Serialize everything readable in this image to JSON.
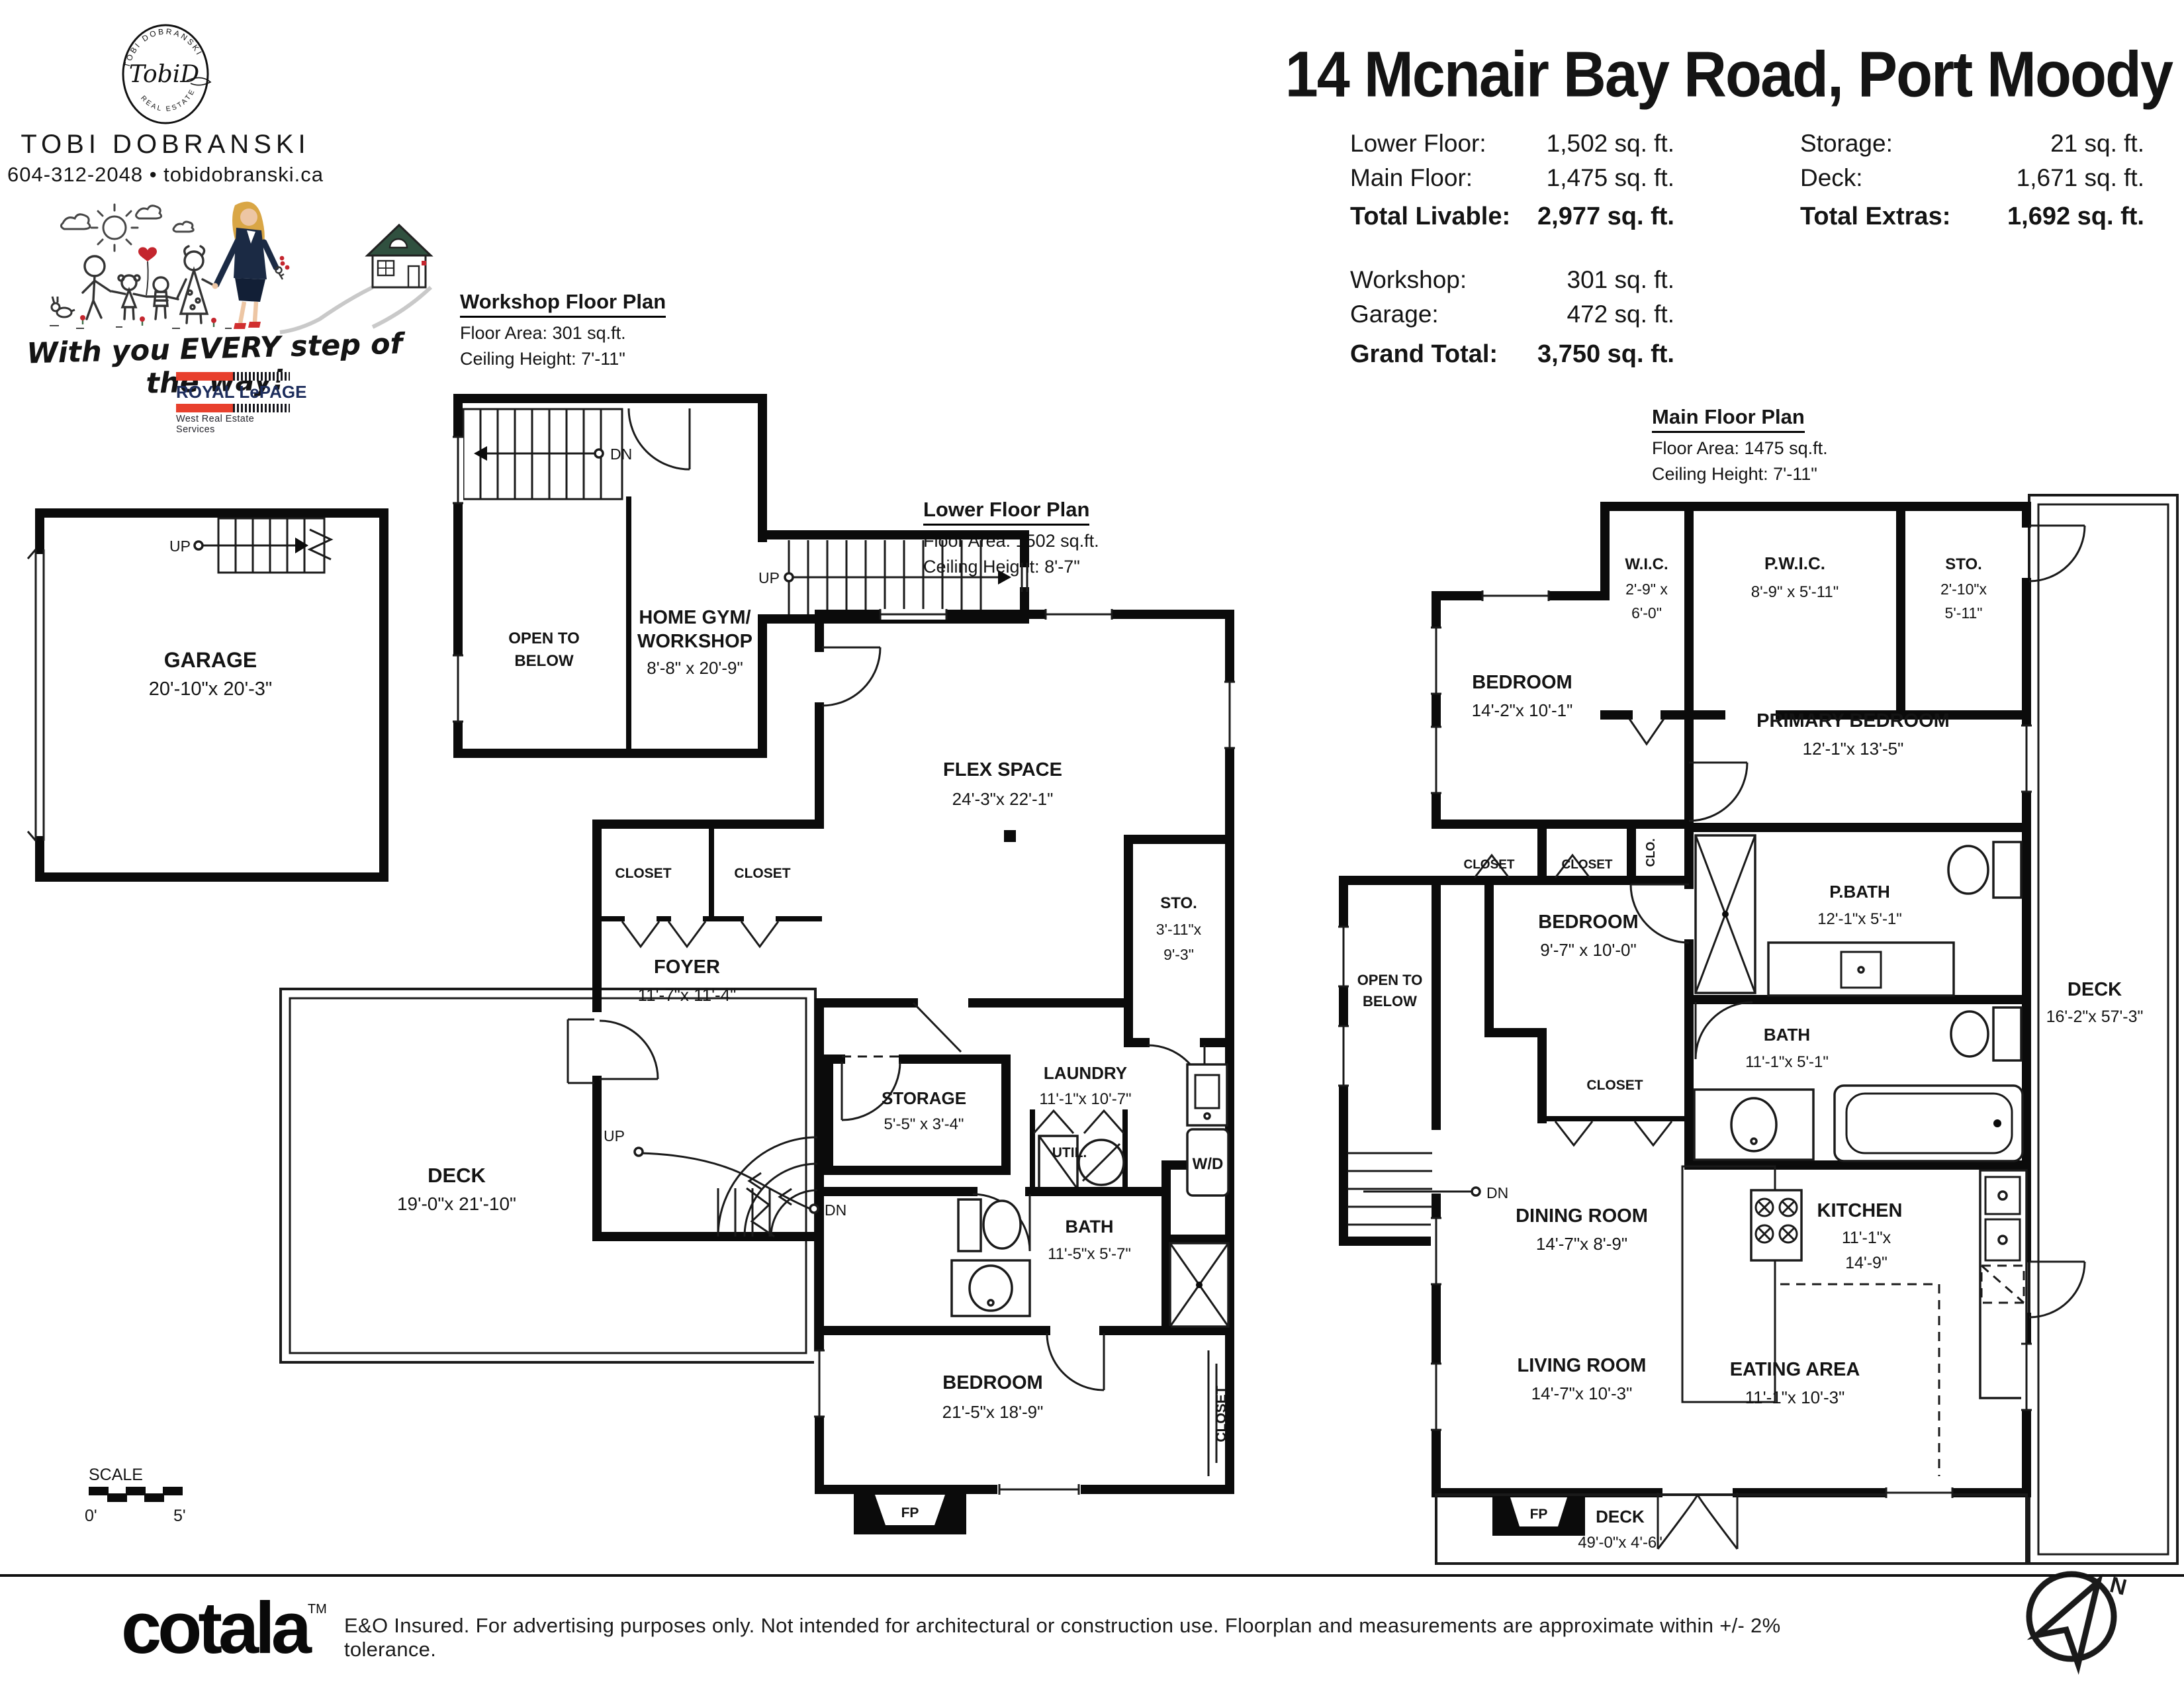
{
  "branding": {
    "logo_arc_top": "TOBI DOBRANSKI",
    "logo_script": "TobiD",
    "logo_arc_bottom": "REAL ESTATE",
    "agent": "TOBI DOBRANSKI",
    "contact": "604-312-2048 • tobidobranski.ca",
    "tagline": "With you EVERY step of the way!",
    "rlp_name": "ROYAL LePAGE",
    "rlp_division": "West Real Estate Services",
    "accent_red": "#e8402d",
    "navy": "#1d2d5c"
  },
  "header": {
    "title": "14 Mcnair Bay Road, Port Moody",
    "stats_left": [
      {
        "label": "Lower Floor:",
        "value": "1,502 sq. ft."
      },
      {
        "label": "Main Floor:",
        "value": "1,475 sq. ft."
      },
      {
        "label": "Total Livable:",
        "value": "2,977 sq. ft."
      }
    ],
    "stats_right": [
      {
        "label": "Storage:",
        "value": "21 sq. ft."
      },
      {
        "label": "Deck:",
        "value": "1,671 sq. ft."
      },
      {
        "label": "Total Extras:",
        "value": "1,692 sq. ft."
      }
    ],
    "stats_extra": [
      {
        "label": "Workshop:",
        "value": "301 sq. ft."
      },
      {
        "label": "Garage:",
        "value": "472 sq. ft."
      },
      {
        "label": "Grand Total:",
        "value": "3,750 sq. ft."
      }
    ]
  },
  "plan_headers": {
    "workshop": {
      "title": "Workshop Floor Plan",
      "area": "Floor Area: 301 sq.ft.",
      "ceiling": "Ceiling Height: 7'-11\""
    },
    "lower": {
      "title": "Lower Floor Plan",
      "area": "Floor Area: 1502 sq.ft.",
      "ceiling": "Ceiling Height: 8'-7\""
    },
    "main": {
      "title": "Main Floor Plan",
      "area": "Floor Area: 1475 sq.ft.",
      "ceiling": "Ceiling Height: 7'-11\""
    }
  },
  "labels": {
    "garage": "GARAGE",
    "garage_d": "20'-10\"x 20'-3\"",
    "up": "UP",
    "dn": "DN",
    "open1": "OPEN TO",
    "open2": "BELOW",
    "gym1": "HOME GYM/",
    "gym2": "WORKSHOP",
    "gym_d": "8'-8\" x 20'-9\"",
    "flex": "FLEX SPACE",
    "flex_d": "24'-3\"x 22'-1\"",
    "sto": "STO.",
    "sto_d1": "3'-11\"x",
    "sto_d2": "9'-3\"",
    "laundry": "LAUNDRY",
    "laundry_d": "11'-1\"x 10'-7\"",
    "util": "UTIL.",
    "wd": "W/D",
    "storage": "STORAGE",
    "storage_d": "5'-5\" x 3'-4\"",
    "bath": "BATH",
    "bath_d": "11'-5\"x 5'-7\"",
    "bed": "BEDROOM",
    "bed_d": "21'-5\"x 18'-9\"",
    "closet": "CLOSET",
    "foyer": "FOYER",
    "foyer_d": "11'-7\"x 11'-4\"",
    "deck": "DECK",
    "deck_lower_d": "19'-0\"x 21'-10\"",
    "fp": "FP",
    "wic": "W.I.C.",
    "wic_d1": "2'-9\" x",
    "wic_d2": "6'-0\"",
    "pwic": "P.W.I.C.",
    "pwic_d": "8'-9\" x 5'-11\"",
    "msto_d1": "2'-10\"x",
    "msto_d2": "5'-11\"",
    "bed1_d": "14'-2\"x 10'-1\"",
    "prim": "PRIMARY BEDROOM",
    "prim_d": "12'-1\"x 13'-5\"",
    "clo": "CLO.",
    "bed2_d": "9'-7\" x 10'-0\"",
    "pbath": "P.BATH",
    "pbath_d": "12'-1\"x 5'-1\"",
    "mbath_d": "11'-1\"x 5'-1\"",
    "deck_right_d": "16'-2\"x 57'-3\"",
    "dining": "DINING ROOM",
    "dining_d": "14'-7\"x 8'-9\"",
    "kitchen": "KITCHEN",
    "kitchen_d1": "11'-1\"x",
    "kitchen_d2": "14'-9\"",
    "living": "LIVING ROOM",
    "living_d": "14'-7\"x 10'-3\"",
    "eating": "EATING AREA",
    "eating_d": "11'-1\"x 10'-3\"",
    "deck_bottom_d": "49'-0\"x 4'-6\""
  },
  "scale_bar": {
    "label": "SCALE",
    "zero": "0'",
    "five": "5'"
  },
  "compass": {
    "n": "N"
  },
  "footer": {
    "brand": "cotala",
    "tm": "TM",
    "disclaimer": "E&O Insured. For advertising purposes only. Not intended for architectural or construction use. Floorplan and measurements are approximate within +/- 2% tolerance."
  }
}
